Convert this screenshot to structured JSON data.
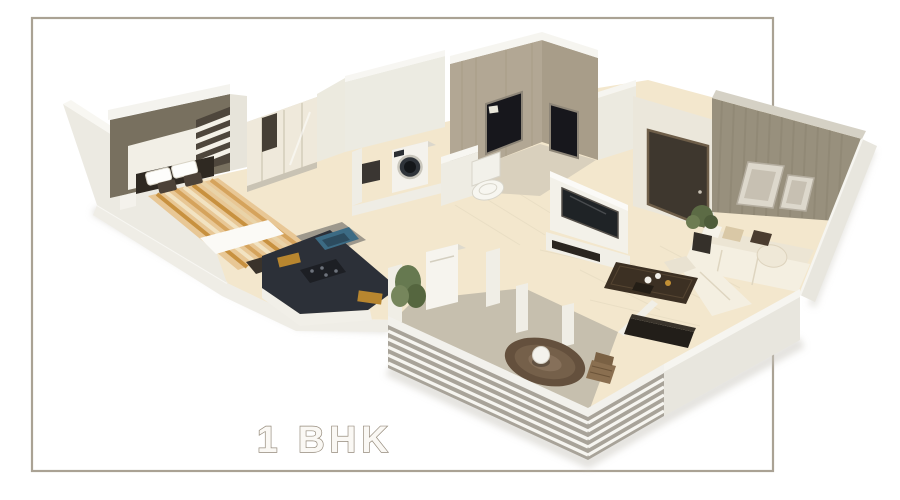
{
  "label": {
    "text": "1 BHK"
  },
  "frame": {
    "border_color": "#aaa294",
    "background": "#ffffff"
  },
  "palette": {
    "floor_cream": "#f3e7cd",
    "floor_balcony": "#c6bfae",
    "floor_bath": "#d9d0bd",
    "wall_white": "#f0eee7",
    "bedroom_accent_wall": "#78705f",
    "bath_tile_wall": "#b2a794",
    "living_texture_wall": "#98907d",
    "kitchen_counter": "#2c3038",
    "sink": "#3c6b84",
    "entrance_door": "#3e372e",
    "tv_screen": "#1f2326",
    "sofa": "#f4efe1",
    "bed_base": "#e8c795",
    "bed_stripe_accent": "#c8913f",
    "round_rug": "#64503d",
    "plant_green": "#5c6b45",
    "label_outline": "#958b7c"
  },
  "rooms": [
    "bedroom",
    "kitchen",
    "utility",
    "bathroom",
    "passage",
    "living-room",
    "balcony"
  ],
  "furniture": [
    "double-bed",
    "wardrobe",
    "bedside-table",
    "bedroom-bench",
    "kitchen-counter",
    "sink",
    "hob",
    "refrigerator",
    "washing-machine",
    "toilet",
    "tv-panel",
    "tv-console",
    "entrance-door",
    "picture-frames",
    "sofa",
    "coffee-table",
    "media-cabinet",
    "potted-plants",
    "round-rug",
    "cafe-table",
    "wicker-chair",
    "balcony-railing"
  ]
}
